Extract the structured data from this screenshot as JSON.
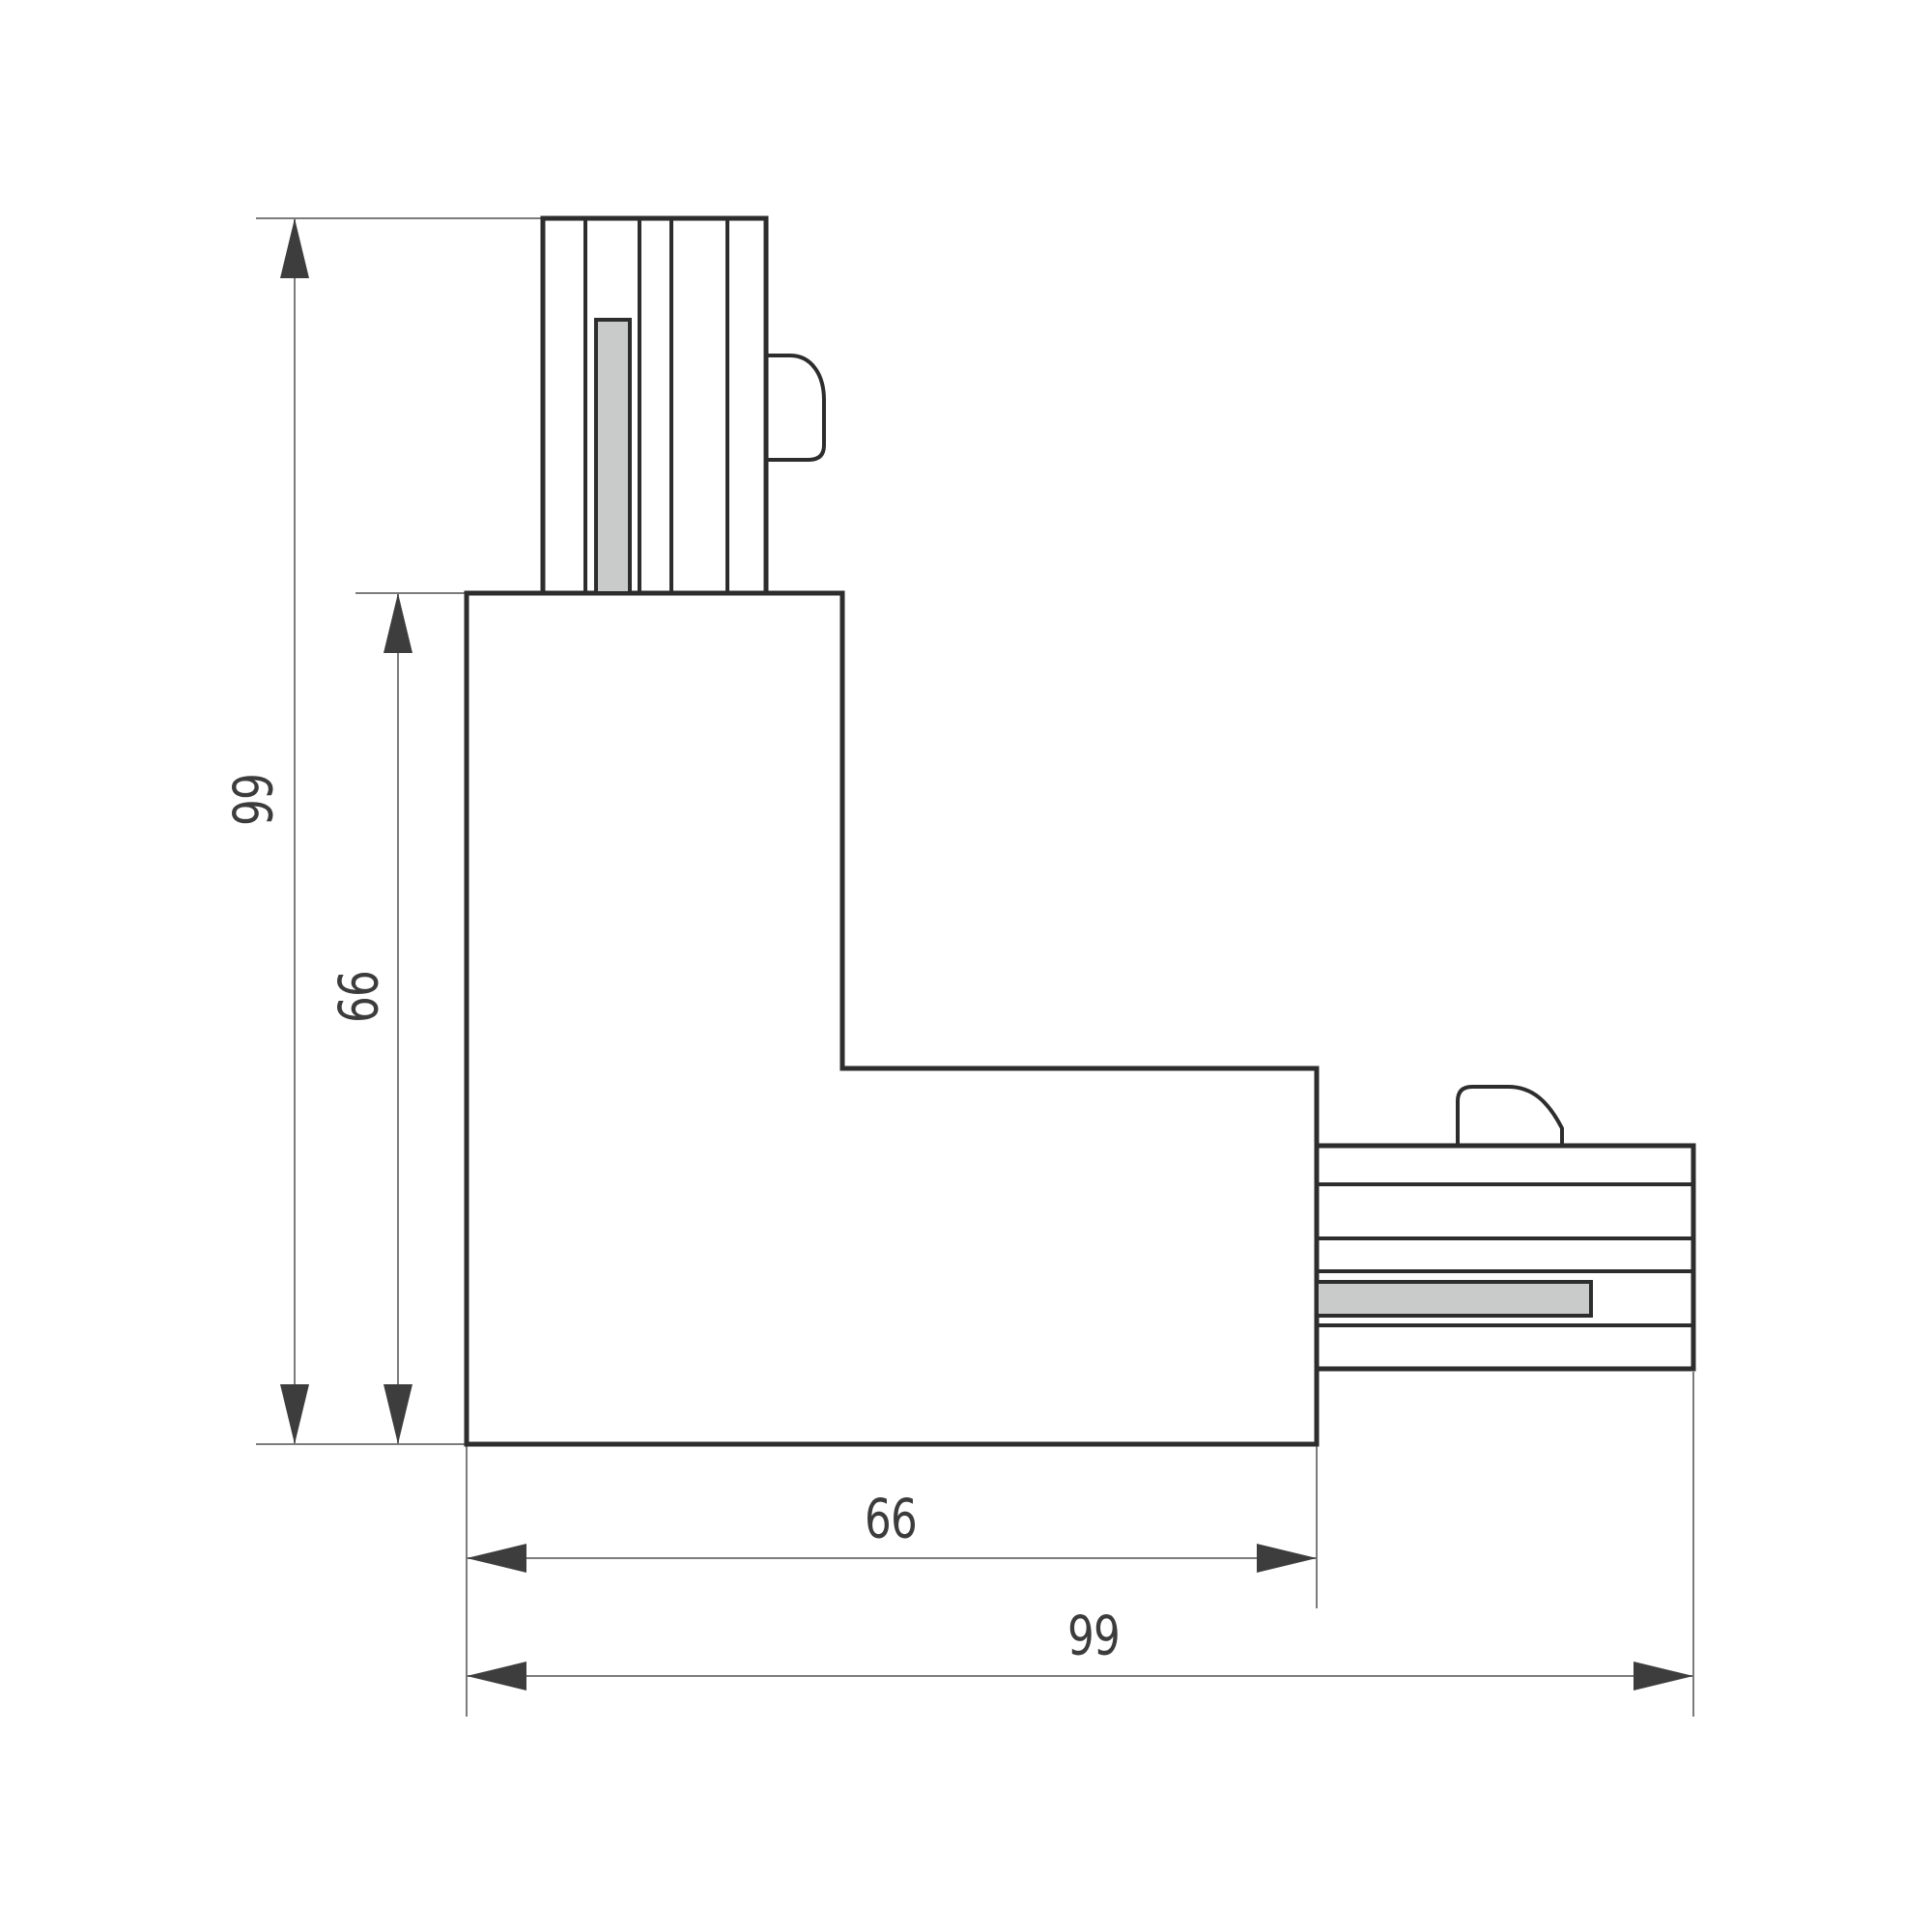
{
  "drawing": {
    "type": "technical-dimension-drawing",
    "subject": "L-shaped track connector, top view",
    "dimensions": {
      "left_total": "99",
      "left_body": "66",
      "bottom_body": "66",
      "bottom_total": "99"
    },
    "colors": {
      "background": "#ffffff",
      "object_line": "#2d2d2d",
      "dimension_line": "#7c7c7c",
      "arrow": "#3d3d3d",
      "text": "#3c3c3c",
      "contact_fill": "#c8cbca"
    }
  }
}
